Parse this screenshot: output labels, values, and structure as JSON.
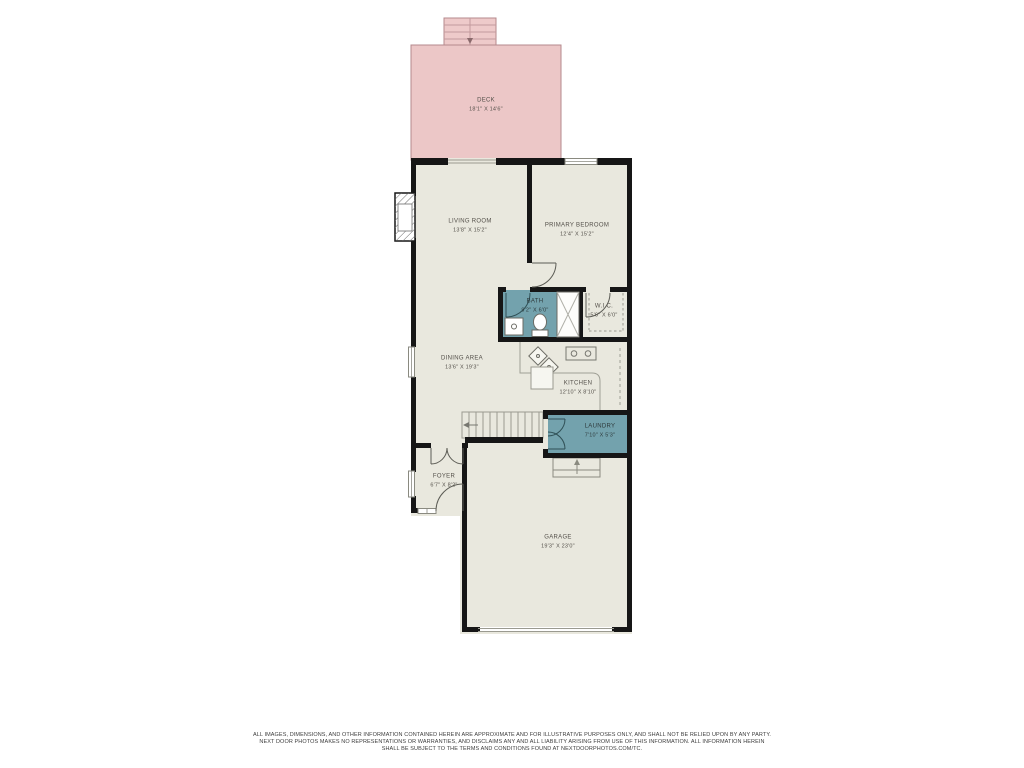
{
  "palette": {
    "background": "#ffffff",
    "wall": "#161616",
    "floor": "#e9e8de",
    "deck_fill": "#ecc7c7",
    "deck_border": "#b5898c",
    "wet_room_fill": "#73a2ad",
    "fixture_line": "#8a8a80",
    "label_color": "#54504a"
  },
  "rooms": [
    {
      "id": "deck",
      "name": "DECK",
      "dims": "18'1\" X 14'6\""
    },
    {
      "id": "living-room",
      "name": "LIVING ROOM",
      "dims": "13'8\" X 15'2\""
    },
    {
      "id": "primary-bedroom",
      "name": "PRIMARY BEDROOM",
      "dims": "12'4\" X 15'2\""
    },
    {
      "id": "bath",
      "name": "BATH",
      "dims": "9'2\" X 6'0\""
    },
    {
      "id": "wic",
      "name": "W.I.C.",
      "dims": "5'6\" X 6'0\""
    },
    {
      "id": "dining-area",
      "name": "DINING AREA",
      "dims": "13'6\" X 19'3\""
    },
    {
      "id": "kitchen",
      "name": "KITCHEN",
      "dims": "12'10\" X 8'10\""
    },
    {
      "id": "laundry",
      "name": "LAUNDRY",
      "dims": "7'10\" X 5'3\""
    },
    {
      "id": "foyer",
      "name": "FOYER",
      "dims": "6'7\" X 8'2\""
    },
    {
      "id": "garage",
      "name": "GARAGE",
      "dims": "19'3\" X 23'0\""
    }
  ],
  "disclaimer": {
    "line1": "ALL IMAGES, DIMENSIONS, AND OTHER INFORMATION CONTAINED HEREIN ARE APPROXIMATE AND FOR ILLUSTRATIVE PURPOSES ONLY, AND SHALL NOT BE RELIED UPON BY ANY PARTY.",
    "line2": "NEXT DOOR PHOTOS MAKES NO REPRESENTATIONS OR WARRANTIES, AND DISCLAIMS ANY AND ALL LIABILITY ARISING FROM USE OF THIS INFORMATION. ALL INFORMATION HEREIN",
    "line3": "SHALL BE SUBJECT TO THE TERMS AND CONDITIONS FOUND AT NEXTDOORPHOTOS.COM/TC."
  }
}
